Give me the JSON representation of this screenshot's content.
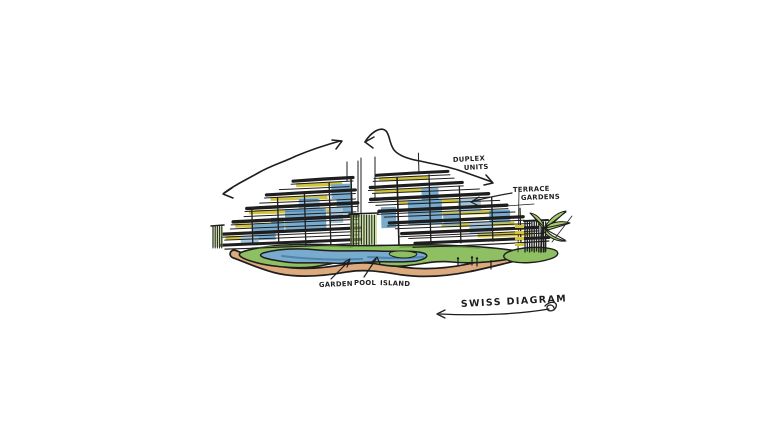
{
  "title": "SWISS DIAGRAM",
  "labels": {
    "duplex_units": {
      "line1": "DUPLEX",
      "line2": "UNITS"
    },
    "terrace_gardens": {
      "line1": "TERRACE",
      "line2": "GARDENS"
    },
    "garden": "GARDEN",
    "pool": "POOL",
    "island": "ISLAND"
  },
  "colors": {
    "paper": "#ffffff",
    "ink": "#1e1e1e",
    "glass-blue": "#79abce",
    "glass-blue-light": "#a3c4da",
    "glass-blue-dark": "#4d85ac",
    "lawn-green": "#8fbf63",
    "lawn-green-dark": "#639540",
    "foliage-green": "#a9cc6b",
    "accent-yellow": "#d2c53c",
    "path-tan": "#dcaa7d"
  }
}
